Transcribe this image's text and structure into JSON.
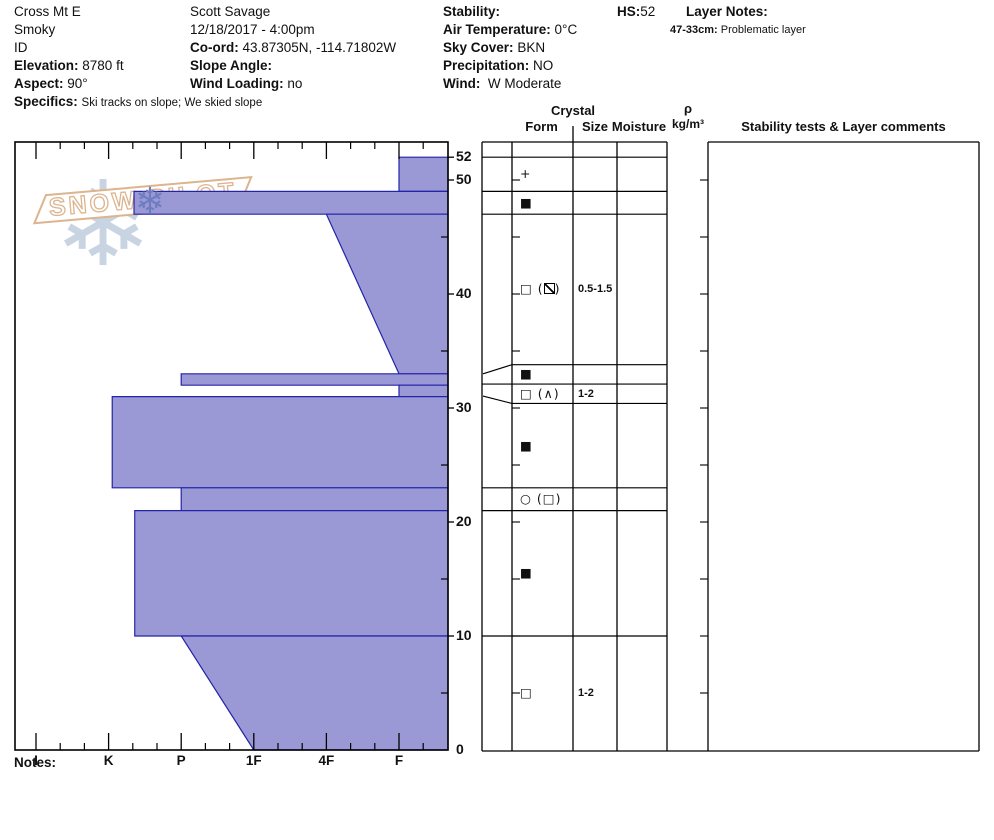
{
  "header": {
    "location": {
      "name": "Cross Mt E",
      "range": "Smoky",
      "state": "ID",
      "elevation_label": "Elevation:",
      "elevation": "8780 ft",
      "aspect_label": "Aspect:",
      "aspect": "90°",
      "specifics_label": "Specifics:",
      "specifics": "Ski tracks on slope; We skied slope"
    },
    "observer": {
      "name": "Scott Savage",
      "datetime": "12/18/2017 - 4:00pm",
      "coord_label": "Co-ord:",
      "coord": "43.87305N, -114.71802W",
      "slope_angle_label": "Slope Angle:",
      "slope_angle": "",
      "wind_loading_label": "Wind Loading:",
      "wind_loading": "no"
    },
    "conditions": {
      "stability_label": "Stability:",
      "stability": "",
      "air_temp_label": "Air Temperature:",
      "air_temp": "0°C",
      "sky_label": "Sky Cover:",
      "sky": "BKN",
      "precip_label": "Precipitation:",
      "precip": "NO",
      "wind_label": "Wind:",
      "wind": "W Moderate"
    },
    "hs_label": "HS:",
    "hs": "52",
    "layer_notes_label": "Layer Notes:",
    "layer_note_range": "47-33cm:",
    "layer_note_text": "Problematic layer"
  },
  "table_headers": {
    "crystal": "Crystal",
    "form": "Form",
    "size": "Size",
    "moisture": "Moisture",
    "rho": "ρ",
    "rho_unit": "kg/m³",
    "comments": "Stability tests & Layer comments"
  },
  "logo": {
    "text": "SNOW PILOT",
    "flake_icon": "snowflake-icon"
  },
  "notes_label": "Notes:",
  "chart_data": {
    "type": "snow-profile-hardness",
    "depth_unit": "cm",
    "hs_cm": 52,
    "depth_axis": {
      "labeled_ticks": [
        0,
        10,
        20,
        30,
        40,
        50,
        52
      ],
      "minor_ticks": [
        5,
        15,
        25,
        35,
        45
      ],
      "range": [
        0,
        53.2
      ]
    },
    "hardness_axis": {
      "labels": [
        "I",
        "K",
        "P",
        "1F",
        "4F",
        "F"
      ],
      "orientation": "hardest-left"
    },
    "layers": [
      {
        "top_cm": 52,
        "bottom_cm": 49,
        "hardness": "F",
        "h_top": 6.0,
        "h_bottom": 6.0,
        "form_primary": "plus",
        "form_secondary": null,
        "size_mm": ""
      },
      {
        "top_cm": 49,
        "bottom_cm": 47,
        "hardness": "K-P",
        "h_top": 2.35,
        "h_bottom": 2.35,
        "form_primary": "filled-square",
        "form_secondary": null,
        "size_mm": ""
      },
      {
        "top_cm": 47,
        "bottom_cm": 33,
        "hardness": "4F→F",
        "h_top": 5.0,
        "h_bottom": 6.0,
        "form_primary": "square",
        "form_secondary": "slash-square",
        "size_mm": "0.5-1.5"
      },
      {
        "top_cm": 33,
        "bottom_cm": 32,
        "hardness": "P",
        "h_top": 3.0,
        "h_bottom": 3.0,
        "form_primary": "filled-square",
        "form_secondary": null,
        "size_mm": ""
      },
      {
        "top_cm": 32,
        "bottom_cm": 31,
        "hardness": "F",
        "h_top": 6.0,
        "h_bottom": 6.0,
        "form_primary": "square",
        "form_secondary": "caret",
        "size_mm": "1-2"
      },
      {
        "top_cm": 31,
        "bottom_cm": 23,
        "hardness": "K",
        "h_top": 2.05,
        "h_bottom": 2.05,
        "form_primary": "filled-square",
        "form_secondary": null,
        "size_mm": ""
      },
      {
        "top_cm": 23,
        "bottom_cm": 21,
        "hardness": "P",
        "h_top": 3.0,
        "h_bottom": 3.0,
        "form_primary": "circle",
        "form_secondary": "square",
        "size_mm": ""
      },
      {
        "top_cm": 21,
        "bottom_cm": 10,
        "hardness": "K-P",
        "h_top": 2.36,
        "h_bottom": 2.36,
        "form_primary": "filled-square",
        "form_secondary": null,
        "size_mm": ""
      },
      {
        "top_cm": 10,
        "bottom_cm": 0,
        "hardness": "P→1F",
        "h_top": 3.0,
        "h_bottom": 4.0,
        "form_primary": "square",
        "form_secondary": null,
        "size_mm": "1-2"
      }
    ],
    "grain_rows": [
      [
        52,
        49
      ],
      [
        49,
        47
      ],
      [
        47,
        33.8
      ],
      [
        33.8,
        32.1
      ],
      [
        32.1,
        30.4
      ],
      [
        30.4,
        23
      ],
      [
        23,
        21
      ],
      [
        21,
        10
      ],
      [
        10,
        0
      ]
    ],
    "leaders": [
      {
        "depth_cm": 33.0,
        "row_depth": 33.8
      },
      {
        "depth_cm": 31.05,
        "row_depth": 30.4
      }
    ],
    "colors": {
      "layer_fill": "#9a99d6",
      "layer_stroke": "#2424a8",
      "flake_light": "#c9d4e3",
      "flake_dark": "#6e7cc2",
      "logo_tan": "#dcb48e"
    }
  }
}
